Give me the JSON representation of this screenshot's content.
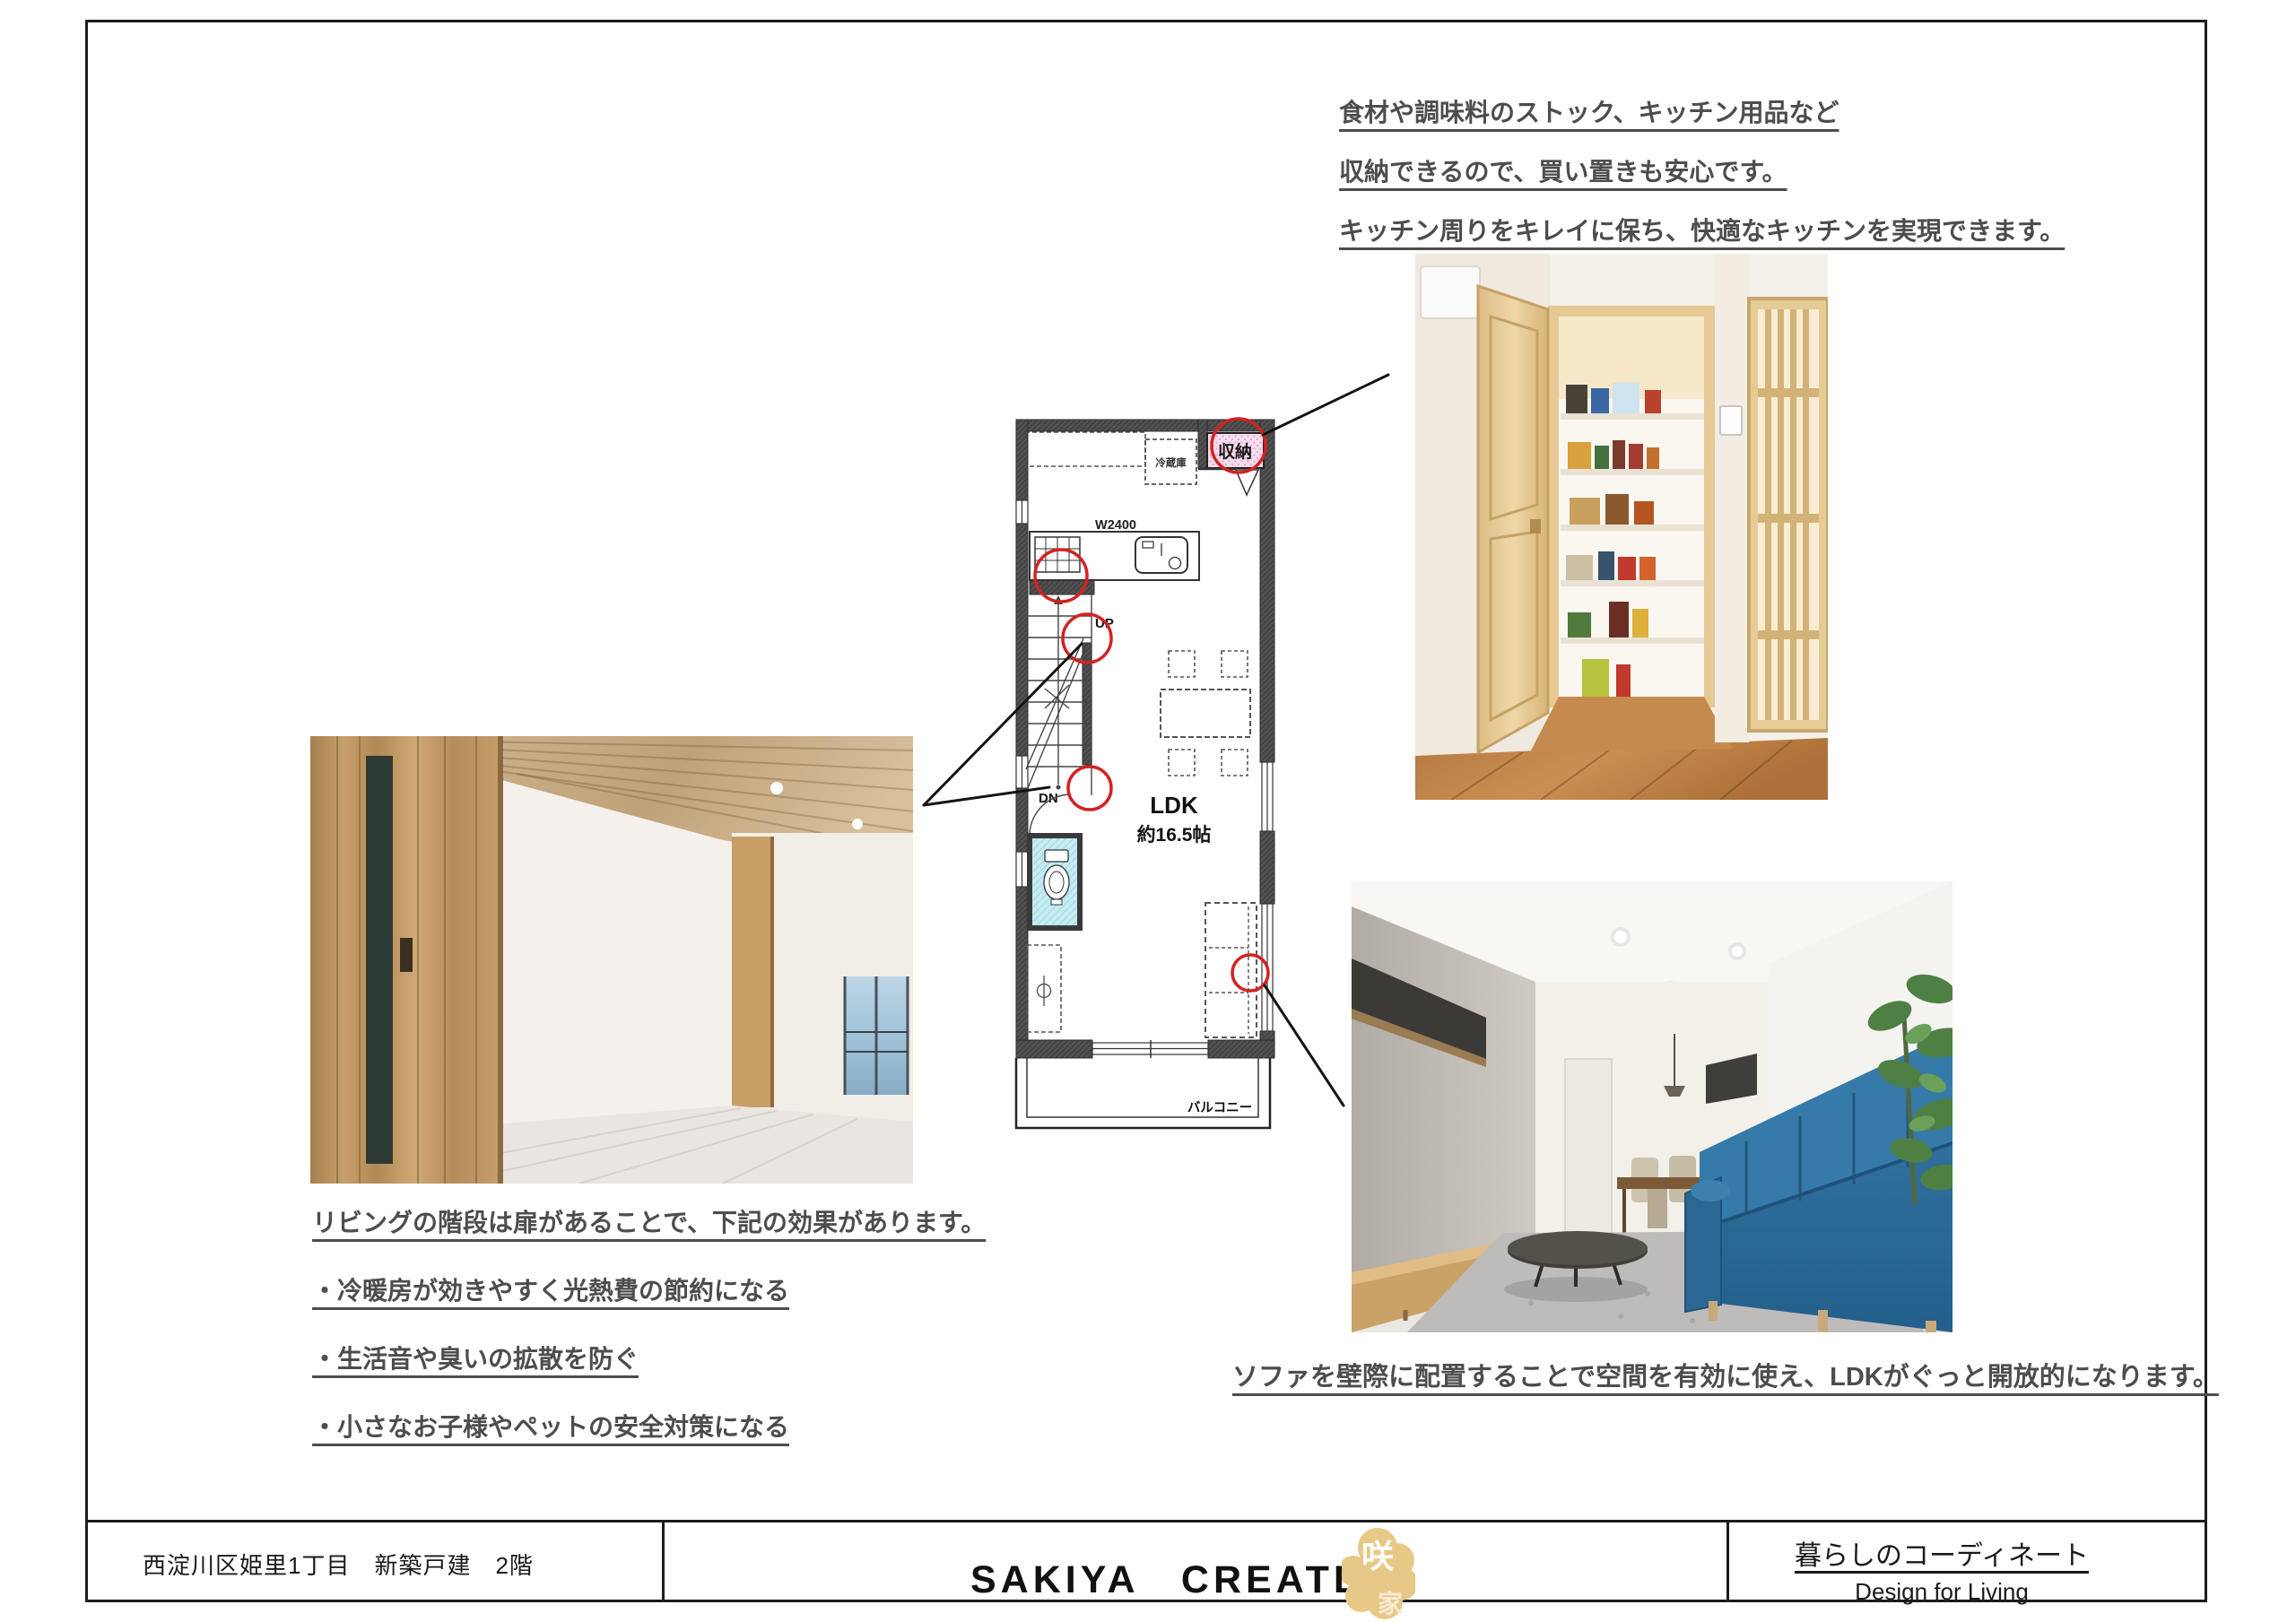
{
  "notes": {
    "kitchen": {
      "l1": "食材や調味料のストック、キッチン用品など",
      "l2": "収納できるので、買い置きも安心です。",
      "l3": "キッチン周りをキレイに保ち、快適なキッチンを実現できます。"
    },
    "stairs": {
      "l1": "リビングの階段は扉があることで、下記の効果があります。",
      "l2": "・冷暖房が効きやすく光熱費の節約になる",
      "l3": "・生活音や臭いの拡散を防ぐ",
      "l4": "・小さなお子様やペットの安全対策になる"
    },
    "sofa": {
      "l1": "ソファを壁際に配置することで空間を有効に使え、LDKがぐっと開放的になります。"
    }
  },
  "plan": {
    "storage": "収納",
    "fridge": "冷蔵庫",
    "width": "W2400",
    "up": "UP",
    "down": "DN",
    "ldk": "LDK",
    "ldk_size": "約16.5帖",
    "balcony": "バルコニー"
  },
  "footer": {
    "property": "西淀川区姫里1丁目　新築戸建　2階",
    "company": "SAKIYA　CREATE",
    "logo_top": "咲",
    "logo_bottom": "家",
    "tagline_jp": "暮らしのコーディネート",
    "tagline_en": "Design for Living"
  },
  "colors": {
    "annotation_red": "#d32222",
    "logo_gold": "#e8c886",
    "note_text_gray": "#4d4d4d",
    "plan_storage_pink": "#f7ddee",
    "plan_toilet_cyan": "#c5ecf2"
  }
}
